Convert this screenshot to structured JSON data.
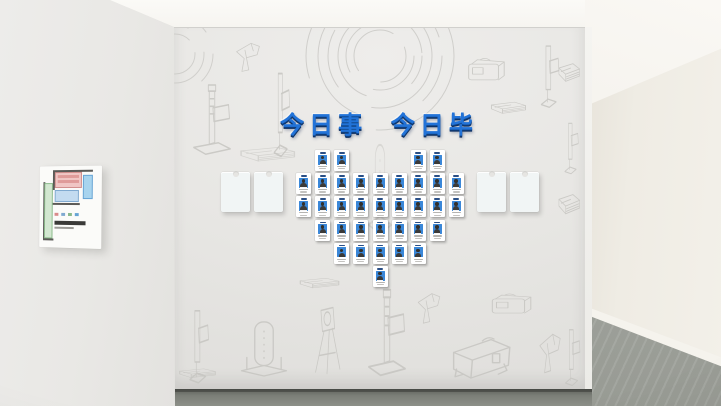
{
  "board": {
    "title": "今日事 今日毕",
    "title_color": "#2273d8",
    "rows": [
      [
        -3,
        -2,
        2,
        3
      ],
      [
        -4,
        -3,
        -2,
        -1,
        0,
        1,
        2,
        3,
        4
      ],
      [
        -4,
        -3,
        -2,
        -1,
        0,
        1,
        2,
        3,
        4
      ],
      [
        -3,
        -2,
        -1,
        0,
        1,
        2,
        3
      ],
      [
        -2,
        -1,
        0,
        1,
        2
      ],
      [
        0
      ]
    ],
    "card": {
      "body_color": "#ffffff",
      "photo_bg": "#3a87d8"
    }
  },
  "pockets": {
    "count": 4,
    "color": "#f1f5f5",
    "positions": [
      {
        "x": 48
      },
      {
        "x": 81
      },
      {
        "x": 304
      },
      {
        "x": 337
      }
    ]
  },
  "floor_plan": {
    "board_color": "#fbfbf9",
    "zones": {
      "red": "#f0c6c4",
      "cyan": "#a8d4ee",
      "blue": "#c3dbf0",
      "green": "#d2e7d0"
    },
    "legend_colors": [
      "#d98b8b",
      "#7fa9d0",
      "#8ab98a",
      "#66a4d4"
    ]
  },
  "palette": {
    "ceiling": "#f8f7f4",
    "main_wall": "#e8e7e4",
    "left_wall": "#eae9e6",
    "hall_wall": "#efece4",
    "floor_front": "#73766f",
    "floor_hall": "#a0a39d",
    "sketch_line": "#c6c5c1"
  },
  "sketches": [
    {
      "t": "gun",
      "x": 56,
      "y": 10,
      "w": 38,
      "h": 38
    },
    {
      "t": "marker",
      "x": 16,
      "y": 54,
      "w": 46,
      "h": 76
    },
    {
      "t": "stand",
      "x": 92,
      "y": 40,
      "w": 30,
      "h": 92
    },
    {
      "t": "screenbox",
      "x": 288,
      "y": 26,
      "w": 48,
      "h": 36
    },
    {
      "t": "stand",
      "x": 358,
      "y": 14,
      "w": 34,
      "h": 68
    },
    {
      "t": "box",
      "x": 312,
      "y": 68,
      "w": 46,
      "h": 28
    },
    {
      "t": "tower",
      "x": 190,
      "y": 104,
      "w": 34,
      "h": 108,
      "o": 0.5
    },
    {
      "t": "box",
      "x": 58,
      "y": 112,
      "w": 72,
      "h": 34,
      "o": 0.6
    },
    {
      "t": "stand",
      "x": 6,
      "y": 278,
      "w": 36,
      "h": 80
    },
    {
      "t": "tower",
      "x": 58,
      "y": 286,
      "w": 66,
      "h": 66
    },
    {
      "t": "tripod",
      "x": 135,
      "y": 275,
      "w": 38,
      "h": 75
    },
    {
      "t": "box",
      "x": 120,
      "y": 245,
      "w": 52,
      "h": 24
    },
    {
      "t": "marker",
      "x": 191,
      "y": 258,
      "w": 46,
      "h": 94
    },
    {
      "t": "gun",
      "x": 238,
      "y": 260,
      "w": 36,
      "h": 40
    },
    {
      "t": "screenbox",
      "x": 311,
      "y": 262,
      "w": 52,
      "h": 32
    },
    {
      "t": "bigbox",
      "x": 272,
      "y": 295,
      "w": 72,
      "h": 64
    },
    {
      "t": "gun",
      "x": 360,
      "y": 299,
      "w": 34,
      "h": 52
    },
    {
      "t": "box",
      "x": 382,
      "y": 26,
      "w": 28,
      "h": 44
    },
    {
      "t": "stand",
      "x": 384,
      "y": 92,
      "w": 26,
      "h": 56
    },
    {
      "t": "box",
      "x": 382,
      "y": 156,
      "w": 28,
      "h": 48
    },
    {
      "t": "stand",
      "x": 384,
      "y": 298,
      "w": 28,
      "h": 62
    },
    {
      "t": "box",
      "x": 0,
      "y": 336,
      "w": 48,
      "h": 22
    }
  ]
}
